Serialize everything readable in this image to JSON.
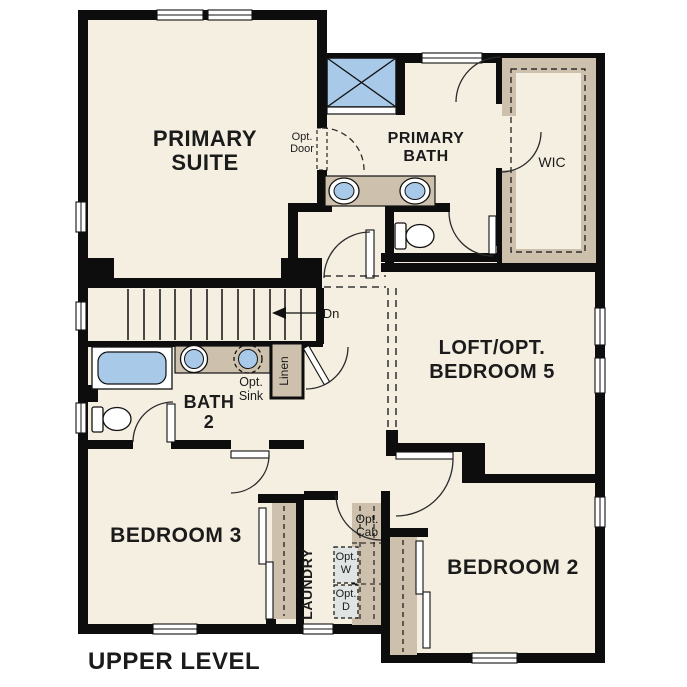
{
  "plan_title": "UPPER LEVEL",
  "rooms": {
    "primary_suite": {
      "line1": "PRIMARY",
      "line2": "SUITE"
    },
    "primary_bath": {
      "line1": "PRIMARY",
      "line2": "BATH"
    },
    "wic": {
      "label": "WIC"
    },
    "loft": {
      "line1": "LOFT/OPT.",
      "line2": "BEDROOM 5"
    },
    "bath_2": {
      "line1": "BATH",
      "line2": "2"
    },
    "bedroom_3": {
      "label": "BEDROOM 3"
    },
    "laundry": {
      "label": "LAUNDRY"
    },
    "bedroom_2": {
      "label": "BEDROOM 2"
    }
  },
  "annotations": {
    "opt_door": {
      "line1": "Opt.",
      "line2": "Door"
    },
    "opt_sink": {
      "line1": "Opt.",
      "line2": "Sink"
    },
    "linen": {
      "label": "Linen"
    },
    "stairs_down": {
      "label": "Dn"
    },
    "opt_cab": {
      "line1": "Opt.",
      "line2": "Cab"
    },
    "opt_washer": {
      "line1": "Opt.",
      "line2": "W"
    },
    "opt_dryer": {
      "line1": "Opt.",
      "line2": "D"
    }
  },
  "colors": {
    "background": "#ffffff",
    "wall": "#0d0d0d",
    "floor": "#f5efe2",
    "fixture_blue": "#a9c9e9",
    "cabinet_tan": "#cdc1ad",
    "appliance_gray": "#e0e5e4"
  }
}
